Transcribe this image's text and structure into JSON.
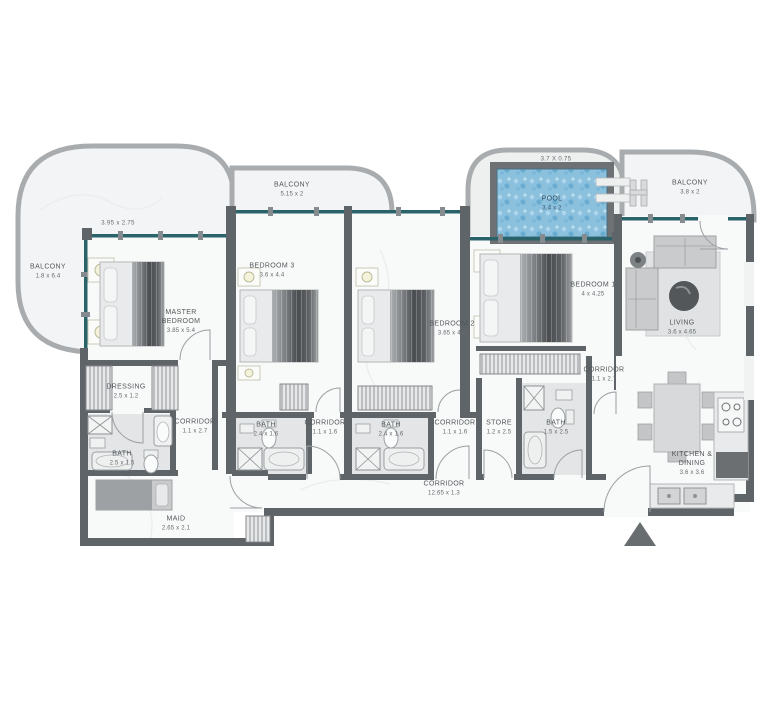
{
  "plan": {
    "type": "apartment-floor-plan",
    "colors": {
      "wall": "#5f6468",
      "window_glazing": "#2a6269",
      "balcony_rail": "#a9acae",
      "floor": "#f8f9f9",
      "bath_floor": "#e3e5e6",
      "pool_water": "#8cc1de",
      "label_text": "#53585c",
      "entry_arrow": "#686d70"
    },
    "labels": {
      "balcony_left": {
        "name": "BALCONY",
        "dims": "1.8 x 6.4"
      },
      "balcony_top": {
        "name": "BALCONY",
        "dims": "5.15 x 2"
      },
      "balcony_right": {
        "name": "BALCONY",
        "dims": "3.8 x 2"
      },
      "pool": {
        "name": "POOL",
        "dims": "3.4 x 2"
      },
      "dim_wing": "3.95 x 2.75",
      "dim_pool_deck": "3.7 X 0.75",
      "master_bedroom": {
        "name": "MASTER BEDROOM",
        "dims": "3.85 x 5.4"
      },
      "bedroom_3": {
        "name": "BEDROOM 3",
        "dims": "3.6 x 4.4"
      },
      "bedroom_2": {
        "name": "BEDROOM 2",
        "dims": "3.65 x 4.4"
      },
      "bedroom_1": {
        "name": "BEDROOM 1",
        "dims": "4 x 4.25"
      },
      "living": {
        "name": "LIVING",
        "dims": "3.6 x 4.65"
      },
      "dressing": {
        "name": "DRESSING",
        "dims": "2.5 x 1.2"
      },
      "bath_master": {
        "name": "BATH",
        "dims": "2.5 x 1.5"
      },
      "corridor_left": {
        "name": "CORRIDOR",
        "dims": "1.1 x 2.7"
      },
      "bath_bedroom3": {
        "name": "BATH",
        "dims": "2.4 x 1.6"
      },
      "corridor_small_1": {
        "name": "CORRIDOR",
        "dims": "1.1 x 1.6"
      },
      "bath_bedroom2": {
        "name": "BATH",
        "dims": "2.4 x 1.6"
      },
      "corridor_small_2": {
        "name": "CORRIDOR",
        "dims": "1.1 x 1.6"
      },
      "store": {
        "name": "STORE",
        "dims": "1.2 x 2.5"
      },
      "bath_bedroom1": {
        "name": "BATH",
        "dims": "1.5 x 2.5"
      },
      "corridor_right": {
        "name": "CORRIDOR",
        "dims": "1.1 x 2.7"
      },
      "corridor_long": {
        "name": "CORRIDOR",
        "dims": "12.65 x 1.3"
      },
      "maid": {
        "name": "MAID",
        "dims": "2.65 x 2.1"
      },
      "kitchen_dining": {
        "name": "KITCHEN & DINING",
        "dims": "3.6 x 3.6"
      }
    }
  }
}
